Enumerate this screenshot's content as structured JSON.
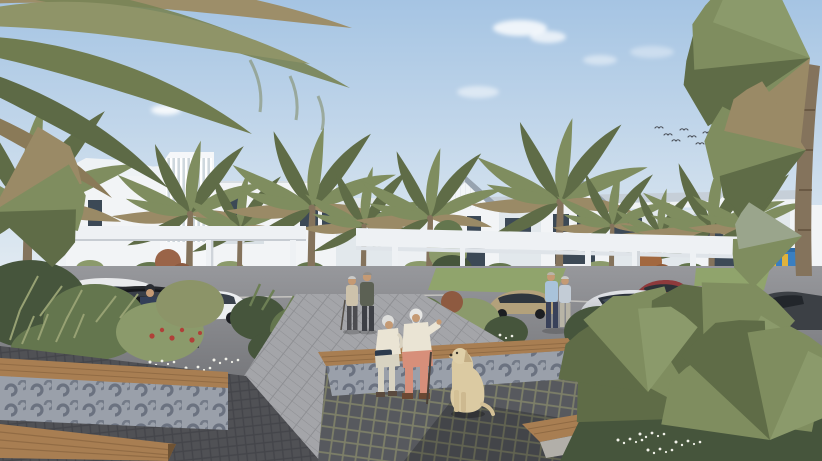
{
  "scene": {
    "type": "architectural-rendering",
    "title": "Residential community courtyard rendering with palm trees, townhouses, carports and seniors relaxing in a plaza",
    "elements": {
      "sky": {
        "weather": "clear with small clouds",
        "birds": "flock of small birds upper right"
      },
      "buildings": [
        "white low-rise apartment block with vertical louvered facade (left)",
        "row of three gable-roofed two-storey townhouses with balconies (center-right)"
      ],
      "structures": [
        "white flat-roof pergola carports over parking bays",
        "children's playground frame behind white picket fence (far right)"
      ],
      "vehicles": [
        {
          "id": "white-hatchback-left-edge",
          "color": "white"
        },
        {
          "id": "white-sedan-behind-suv",
          "color": "white"
        },
        {
          "id": "black-suv",
          "color": "black"
        },
        {
          "id": "white-coupe",
          "color": "white"
        },
        {
          "id": "gold-sedan",
          "color": "gold-beige"
        },
        {
          "id": "red-car-roof",
          "color": "dark red"
        },
        {
          "id": "mauve-sedan",
          "color": "mauve-grey"
        },
        {
          "id": "silver-coupe",
          "color": "silver"
        },
        {
          "id": "dark-car-right-edge",
          "color": "charcoal"
        }
      ],
      "people": [
        {
          "id": "walking-man-back-view",
          "outfit": "navy tee, light shorts, dark cap"
        },
        {
          "id": "walking-woman-shawl",
          "outfit": "black dress, dark red shawl, pulling small trolley"
        },
        {
          "id": "two-men-strolling",
          "outfit": "beige shirt with cane; grey-green jacket"
        },
        {
          "id": "standing-couple",
          "outfit": "light blue shirt with jeans; woman in light top"
        },
        {
          "id": "seated-elderly-woman",
          "outfit": "cream cardigan, light trousers, reading book"
        },
        {
          "id": "seated-elderly-man",
          "outfit": "cream sweater, salmon trousers, walking cane"
        }
      ],
      "animals": [
        {
          "id": "yellow-labrador",
          "pose": "sitting facing seated couple"
        }
      ],
      "landscape": [
        "large palm canopy top-left",
        "tall fan palm right edge",
        "row of coconut palms along skyline",
        "lush planting beds with white daisies and red flowers",
        "green lawns",
        "fan-palm shrub foreground right"
      ],
      "furniture": [
        "timber bench tops on patterned concrete planter walls",
        "sunken plaza with dark sett paving and perimeter timber benches",
        "light grey paver walkway"
      ]
    }
  },
  "palette": {
    "sky_top": "#a5c4e3",
    "sky_horizon": "#e7eef3",
    "cloud": "#ffffff",
    "building": "#f2f4f6",
    "building_shade": "#e2e8ec",
    "roof": "#97a3b0",
    "roof_light": "#c6cfd8",
    "window": "#3c4956",
    "pergola": "#eef1f4",
    "hedge": "#6d7d54",
    "grass": "#90a46c",
    "asphalt": "#8c8d91",
    "paver": "#a4a5a9",
    "cobble": "#57595e",
    "cobble_joint": "#7d7f68",
    "cobble_dark": "#505155",
    "concrete": "#cbc8c2",
    "concrete_dark": "#b2afa9",
    "wood": "#a87e52",
    "motif_bg": "#9aa0aa",
    "motif": "#6b7280",
    "trunk": "#84735c",
    "frond": "#7f8d5f",
    "frond_dark": "#5f6c47",
    "frond_dry": "#9a8a66",
    "leaf_dark": "#46553c",
    "leaf_mid": "#64764e",
    "leaf_light": "#8b9a6b",
    "daisy": "#f2f2ea",
    "flower_red": "#b04038",
    "flower_rust": "#9a6448",
    "dog_coat": "#dbcaa2",
    "skin": "#c59a74",
    "hair_silver": "#dddddb",
    "cream": "#eae4d4",
    "salmon": "#d78f7a",
    "navy": "#333f58",
    "shawl": "#7e3430",
    "denim": "#39415a",
    "shirt_blue": "#a9c3da",
    "car_black": "#26282c",
    "car_white": "#eceef0",
    "car_silver": "#c6c9ce",
    "car_gold": "#b3a17b",
    "car_mauve": "#a09399",
    "car_red": "#8e3a3c",
    "car_dark": "#3c4045",
    "play_blue": "#3a7fc1",
    "play_yellow": "#e0b23c",
    "bird": "#4a4f58"
  }
}
